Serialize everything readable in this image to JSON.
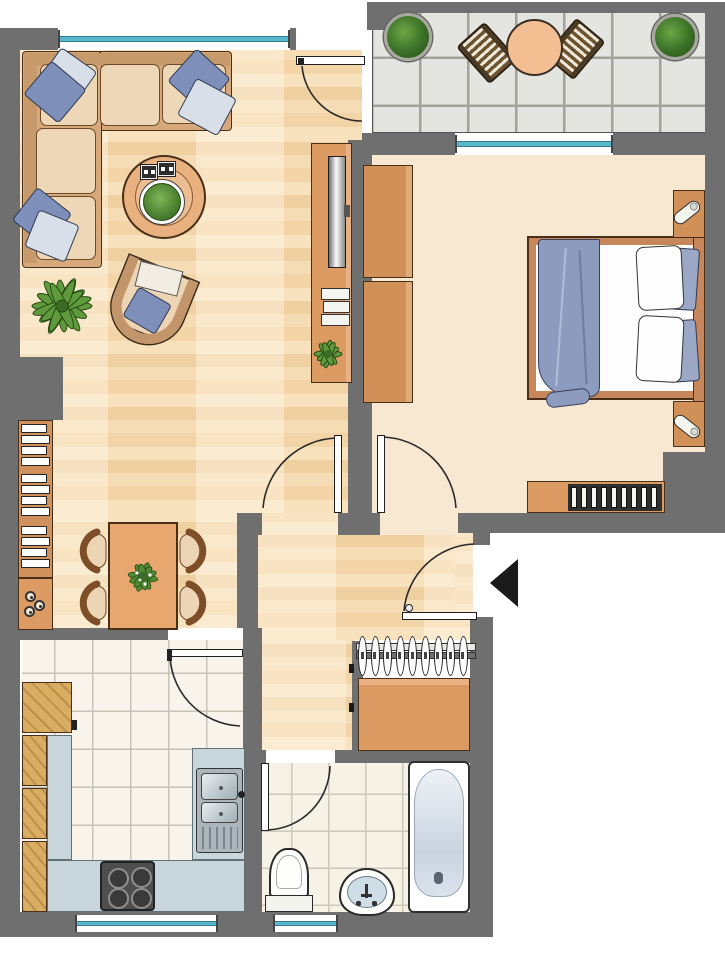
{
  "meta": {
    "kind": "apartment-floor-plan",
    "style": "furnished color plan, top view"
  },
  "colors": {
    "wall": "#6f6f6f",
    "outline": "#4a2f18",
    "floorWood": "#f5d9b0",
    "floorCream": "#f8e8d2",
    "tileK": "#f8f4ec",
    "groutK": "#c6c2b6",
    "tileB": "#f7f2e6",
    "groutB": "#ccc8ba",
    "balconyTile": "#e4e4e0",
    "balconyGrout": "#a2a29a",
    "teal": "#58b7c9",
    "tealDark": "#2f7f93",
    "orange": "#dd9b64",
    "orangeDark": "#d09058",
    "woodCab": "#d9ad62",
    "counter": "#c9d6dc",
    "sofa": "#d6a87a",
    "sofaBack": "#c79a6c",
    "cushion": "#eed7b6",
    "seat": "#ecd4b4",
    "chairBack": "#7d4e28",
    "textileBlue": "#7e90ba",
    "textileLight": "#d8dfe9",
    "blanket": "#8d9cbe",
    "pillowBlue": "#9aa8c6",
    "green": "#5f9a3c",
    "greenDark": "#274a15",
    "appliance": "#4e4e4e",
    "basin": "#cfdde6",
    "arrow": "#1a1a1a"
  },
  "rooms": [
    {
      "id": "living-room",
      "furniture": [
        "corner-sofa",
        "blue-pillows",
        "coffee-table-with-plant",
        "armchair",
        "potted-palm",
        "tv-sideboard-with-plant"
      ]
    },
    {
      "id": "dining-area",
      "furniture": [
        "dining-table-with-centerpiece",
        "four-chairs",
        "bookshelf",
        "small-cabinet"
      ]
    },
    {
      "id": "balcony",
      "furniture": [
        "round-table",
        "two-slatted-chairs",
        "two-round-bushes"
      ]
    },
    {
      "id": "bedroom",
      "furniture": [
        "double-bed",
        "blue-blanket",
        "pillows",
        "wardrobe",
        "two-nightstands-with-lamps",
        "sideboard-with-record-rack"
      ]
    },
    {
      "id": "hallway",
      "furniture": [
        "coat-rack-with-hangers",
        "cabinet"
      ]
    },
    {
      "id": "kitchen",
      "furniture": [
        "wood-cabinets",
        "l-shaped-counter",
        "double-sink",
        "stove-4-burners"
      ]
    },
    {
      "id": "bathroom",
      "furniture": [
        "bathtub",
        "toilet",
        "washbasin"
      ]
    }
  ],
  "doors": [
    "balcony-door",
    "living-room-door",
    "bedroom-door",
    "entrance-door",
    "kitchen-door",
    "bathroom-door"
  ],
  "entrance_marker": "black-arrow-pointing-left",
  "repeat": {
    "coat_hangers": 9,
    "stove_burners": 4,
    "record_slats": 9,
    "book_sections": 3,
    "book_rows": 4,
    "cabinet_circles": 3
  }
}
